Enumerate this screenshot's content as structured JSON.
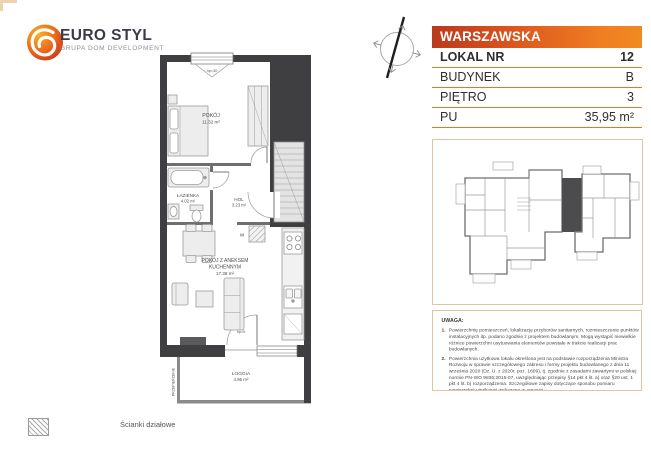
{
  "doc": {
    "brand": {
      "name": "EURO STYL",
      "tagline": "GRUPA DOM DEVELOPMENT"
    },
    "header": {
      "street": "WARSZAWSKA"
    },
    "unit_table": {
      "rows": [
        {
          "label": "LOKAL NR",
          "value": "12"
        },
        {
          "label": "BUDYNEK",
          "value": "B"
        },
        {
          "label": "PIĘTRO",
          "value": "3"
        },
        {
          "label": "PU",
          "value": "35,95 m²"
        }
      ]
    },
    "floor_plan": {
      "rooms": {
        "pokoj": {
          "name": "POKÓJ",
          "area": "11.32 m²"
        },
        "lazienka": {
          "name": "ŁAZIENKA",
          "area": "4.02 m²"
        },
        "hol": {
          "name": "HOL",
          "area": "3.23 m²"
        },
        "pokoj_aneks": {
          "name_line1": "POKÓJ Z ANEKSEM",
          "name_line2": "KUCHENNYM",
          "area": "17.38 m²"
        },
        "loggia": {
          "name": "LOGGIA",
          "area": "4.86 m²"
        }
      },
      "annotations": {
        "window_sill": "hp=30",
        "loggia_door_sill": "hp=0",
        "washer": "W",
        "partition_screen": "PRZEPIERZENIE"
      }
    },
    "notes": {
      "title": "UWAGA:",
      "items": [
        {
          "num": "1.",
          "text": "Powierzchnię pomieszczeń, lokalizację przyborów sanitarnych, rozmieszczenie punktów instalacyjnych itp. podano zgodnie z projektem budowlanym. Mogą wystąpić niewielkie różnice powierzchni usytuowania elementów powstałe w trakcie realizacji prac budowlanych."
        },
        {
          "num": "2.",
          "text": "Powierzchnia użytkowa lokalu określona jest na podstawie rozporządzenia Ministra Rozwoju w sprawie szczegółowego zakresu i formy projektu budowlanego z dnia 11 września 2020 (Dz. U. z 2020r. poz. 1609), tj. zgodnie z zasadami zawartymi w polskiej normie PN-ISO 9836:2015-07, uwzględniając przepisy §14 pkt 4 lit. a) oraz §20 ust. 1 pkt 4 lit. b) rozporządzenia. Szczegółowe zapisy dotyczące sposobu pomiaru powierzchni użytkowej wskazano w umowie."
        },
        {
          "num": "3.",
          "text": "Przedstawiona na rzucie aranżacja ma charakter przykładowy, umeblowanie i zabudowy instalacyjne nie stanowią wyposażenia nabywanego lokalu"
        }
      ]
    },
    "legend": {
      "partition_walls": "Ścianki działowe"
    },
    "colors": {
      "accent_orange": "#E87722",
      "header_gradient_left": "#B93A1D",
      "header_gradient_right": "#F28A1F",
      "wall_dark": "#3F3F41",
      "frame_tan": "#E0C5A3"
    }
  }
}
